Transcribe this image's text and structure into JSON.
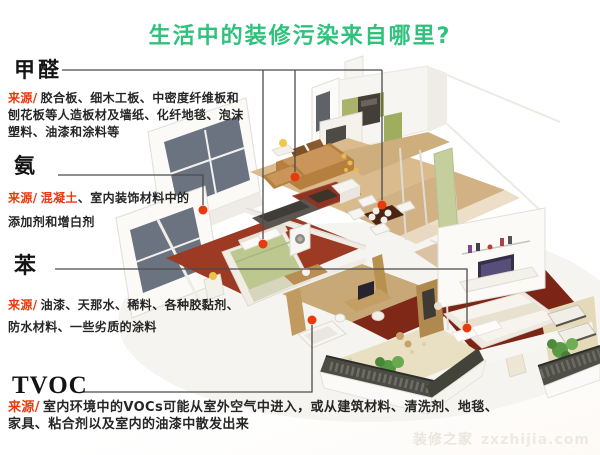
{
  "title": {
    "text": "生活中的装修污染来自哪里?",
    "color": "#2fc27d"
  },
  "colors": {
    "accent_red": "#e83a0f",
    "callout_line": "#4b4b4b",
    "title_green": "#2fc27d"
  },
  "sections": [
    {
      "id": "formaldehyde",
      "name": "甲醛",
      "source_label": "来源/",
      "desc": "胶合板、细木工板、中密度纤维板和\n刨花板等人造板材及墙纸、化纤地毯、泡沫\n塑料、油漆和涂料等"
    },
    {
      "id": "ammonia",
      "name": "氨",
      "source_label": "来源/",
      "desc_red": "混凝土",
      "desc": "、室内装饰材料中的\n添加剂和增白剂"
    },
    {
      "id": "benzene",
      "name": "苯",
      "source_label": "来源/",
      "desc": "油漆、天那水、稀料、各种胶黏剂、\n防水材料、一些劣质的涂料"
    },
    {
      "id": "tvoc",
      "name": "TVOC",
      "source_label": "来源/",
      "desc": "室内环境中的VOCs可能从室外空气中进入，或从建筑材料、清洗剂、地毯、\n家具、粘合剂以及室内的油漆中散发出来"
    }
  ],
  "watermark": {
    "site_name": "装修之家",
    "domain": "zxzhijia.com"
  }
}
